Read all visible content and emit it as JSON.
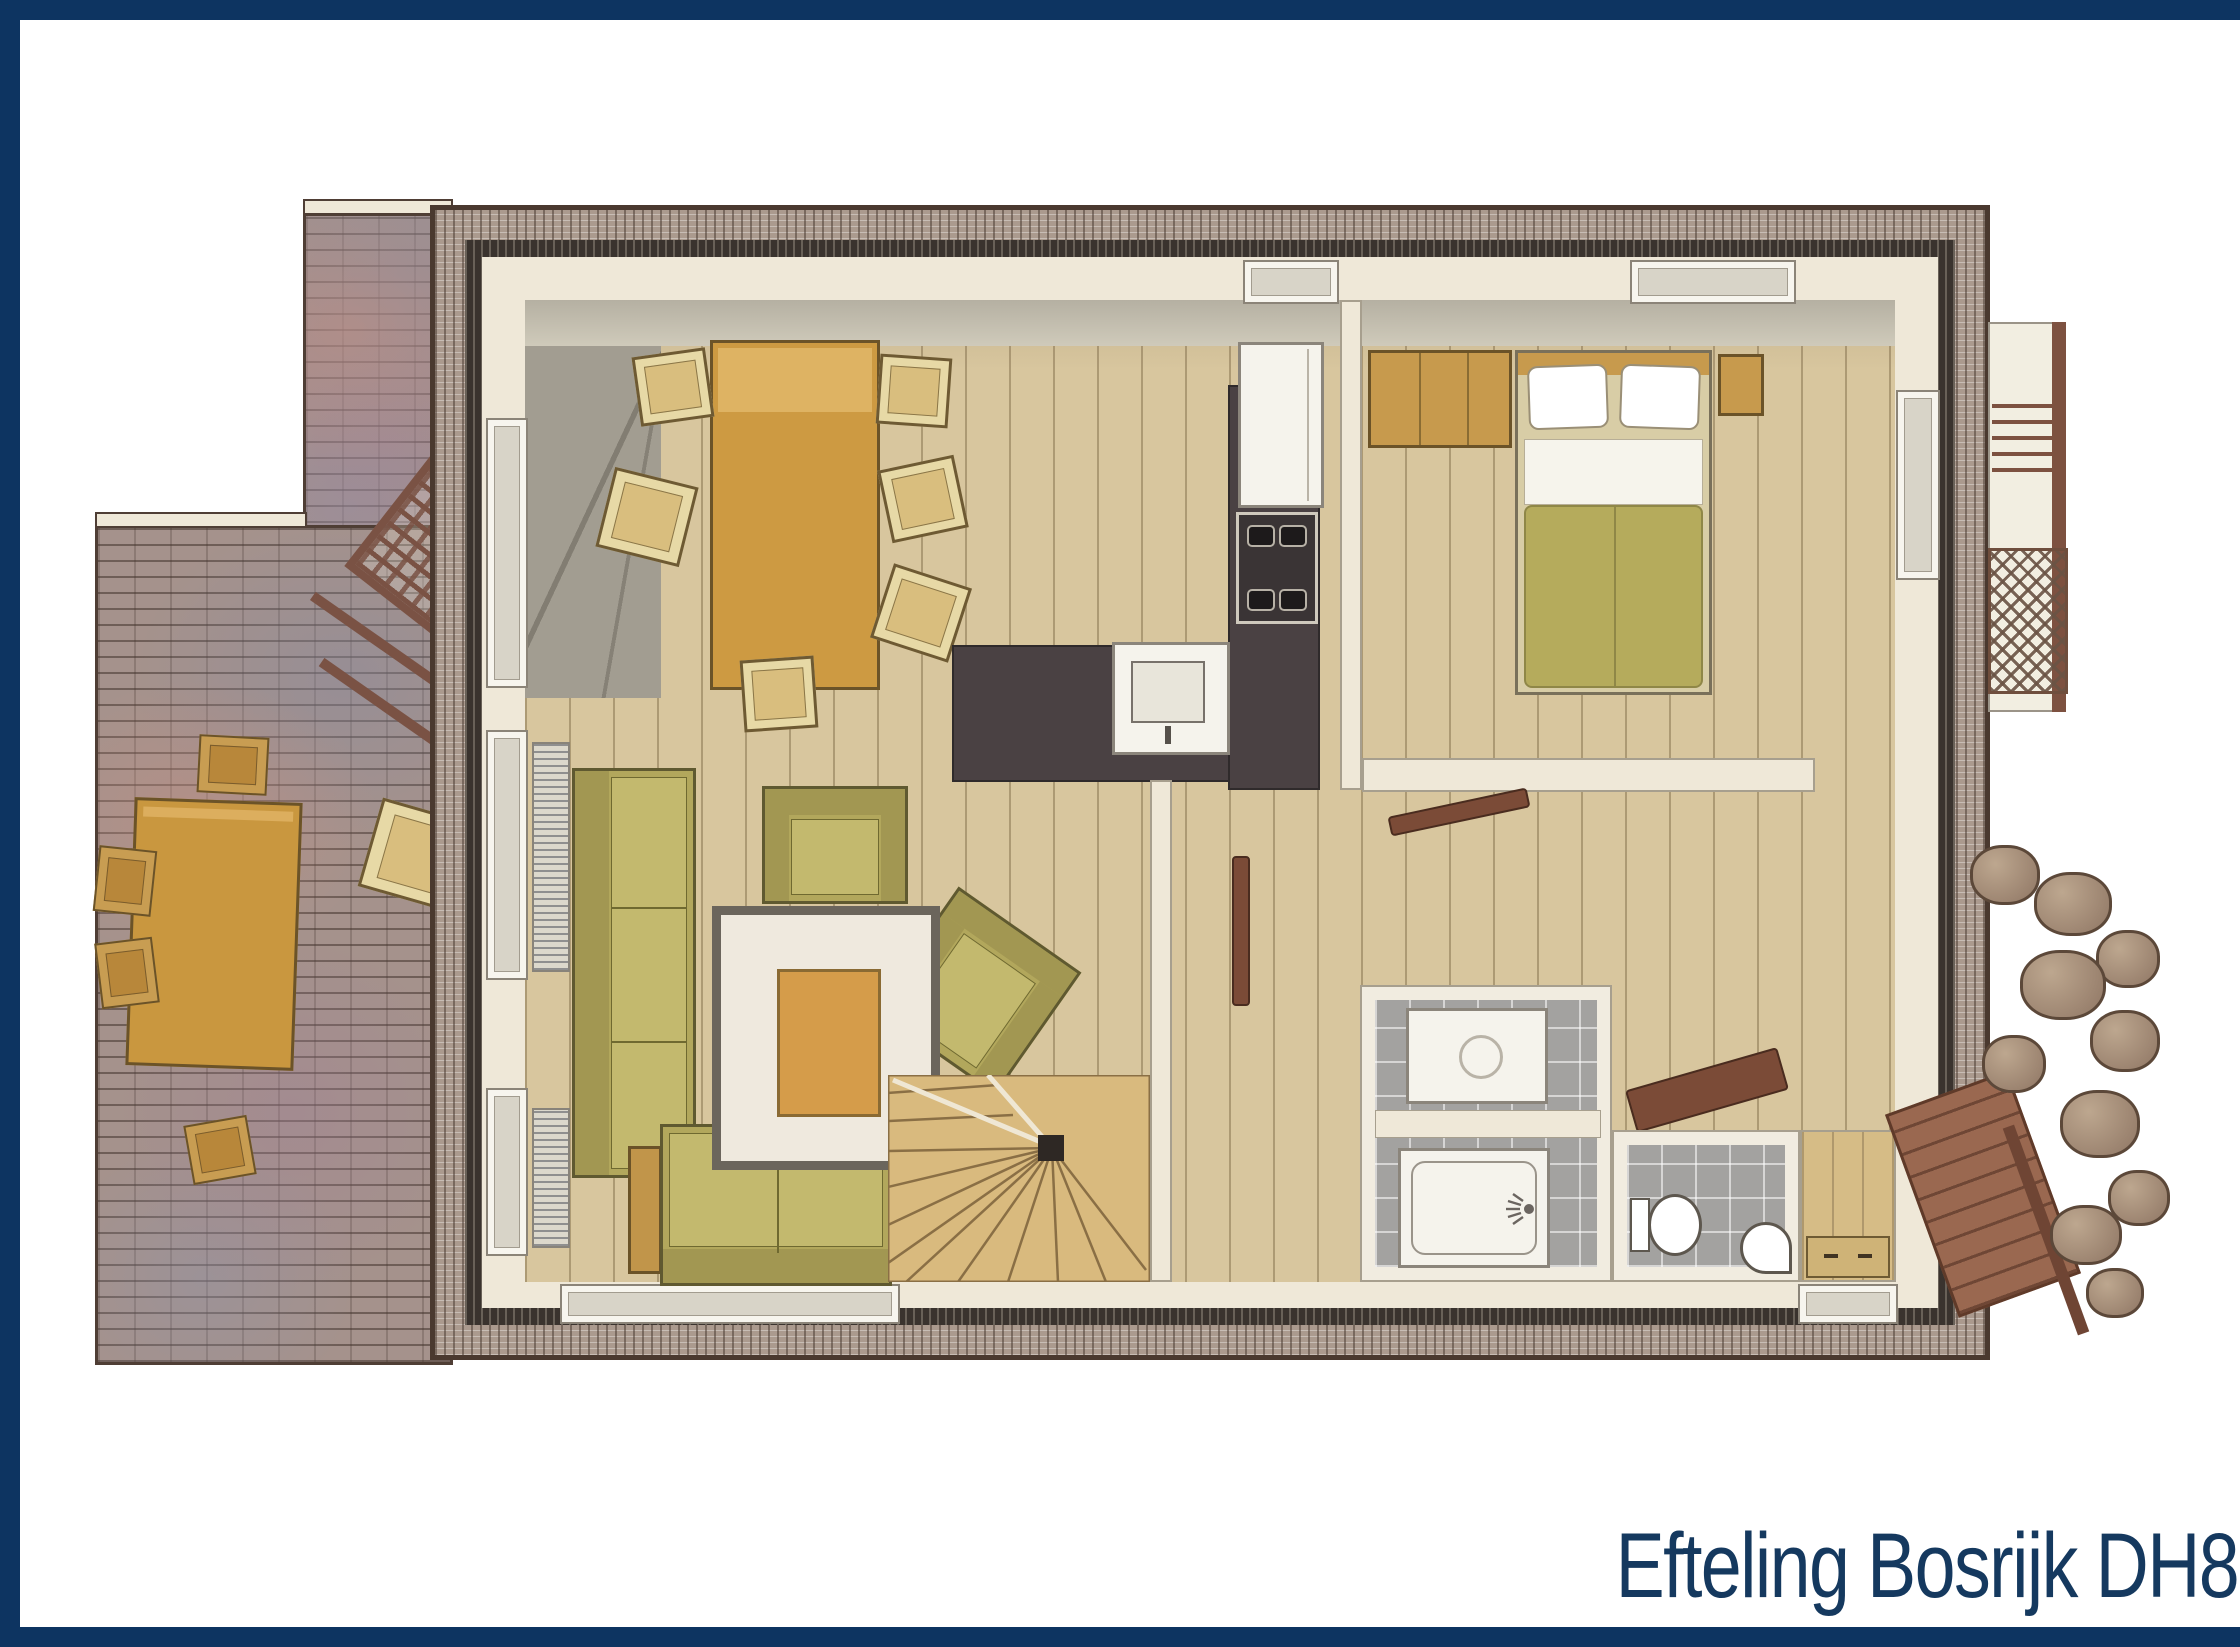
{
  "title": {
    "text": "Efteling Bosrijk DH8"
  },
  "plan": {
    "type": "floor-plan",
    "areas": [
      "terrace",
      "living-room",
      "dining-area",
      "open-kitchen",
      "bedroom",
      "hallway",
      "staircase",
      "bathroom",
      "shower",
      "toilet",
      "entrance",
      "balcony",
      "porch",
      "rock-garden"
    ]
  },
  "colors": {
    "frame_navy": "#0d3461",
    "title_text": "#15395f",
    "background": "#ffffff",
    "wood_floor": "#d8c69e",
    "terrace_brick": "#a5928c",
    "wall_cream": "#efe8d8",
    "wall_dark": "#3a332e",
    "kitchen_counter": "#4a4143",
    "sofa_olive": "#b2a75c",
    "furniture_tan": "#c9973f",
    "duvet_olive": "#b5ab5c",
    "tile_gray": "#a3a2a0",
    "porch_brown": "#9a6850"
  }
}
